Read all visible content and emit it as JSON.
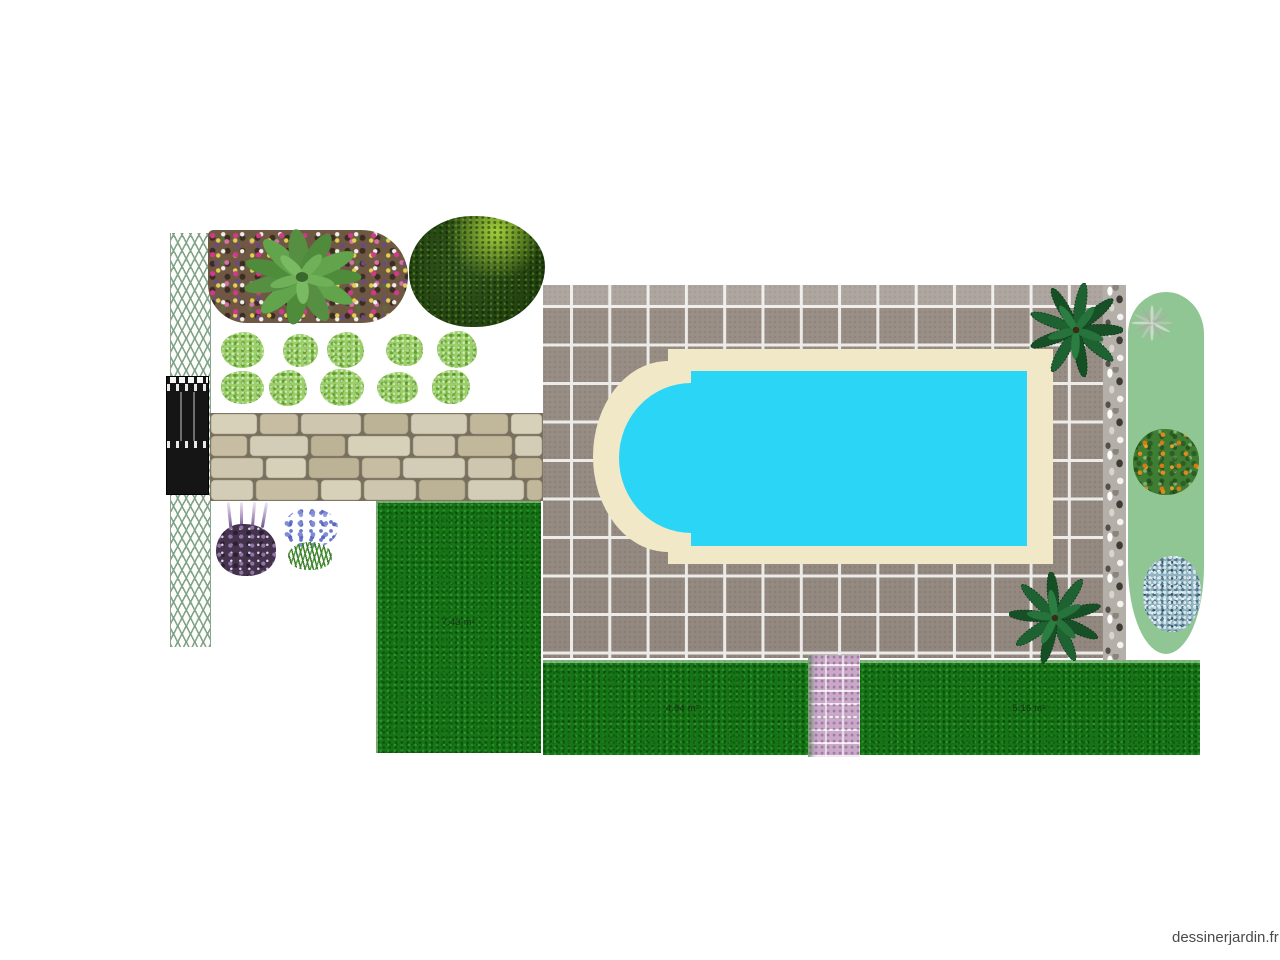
{
  "plan": {
    "watermark": "dessinerjardin.fr",
    "lawns": {
      "left": {
        "area_label": "7.43 m²"
      },
      "middle": {
        "area_label": "4.94 m²"
      },
      "right": {
        "area_label": "5.16 m²"
      }
    },
    "objects": [
      {
        "name": "trellis-fence"
      },
      {
        "name": "garden-gate"
      },
      {
        "name": "flower-bed"
      },
      {
        "name": "large-leaf-plant"
      },
      {
        "name": "boxwood-ball"
      },
      {
        "name": "shrub",
        "count": 10
      },
      {
        "name": "stone-wall"
      },
      {
        "name": "lavender-plant"
      },
      {
        "name": "agapanthus-plant"
      },
      {
        "name": "tiled-terrace"
      },
      {
        "name": "swimming-pool-roman-end"
      },
      {
        "name": "palm-tree",
        "count": 2
      },
      {
        "name": "rock-border"
      },
      {
        "name": "planting-bed-oval"
      },
      {
        "name": "agave-plant"
      },
      {
        "name": "orange-tree"
      },
      {
        "name": "silver-shrub"
      },
      {
        "name": "gravel-path"
      }
    ],
    "colors": {
      "pool_water": "#2bd5f5",
      "pool_coping": "#f0e8c6",
      "terrace_tile": "#958b82",
      "lawn": "#157515",
      "bed_oval": "#90c693",
      "gravel_path": "#c9a8ca",
      "watermark_text": "#4a4a4a"
    }
  }
}
